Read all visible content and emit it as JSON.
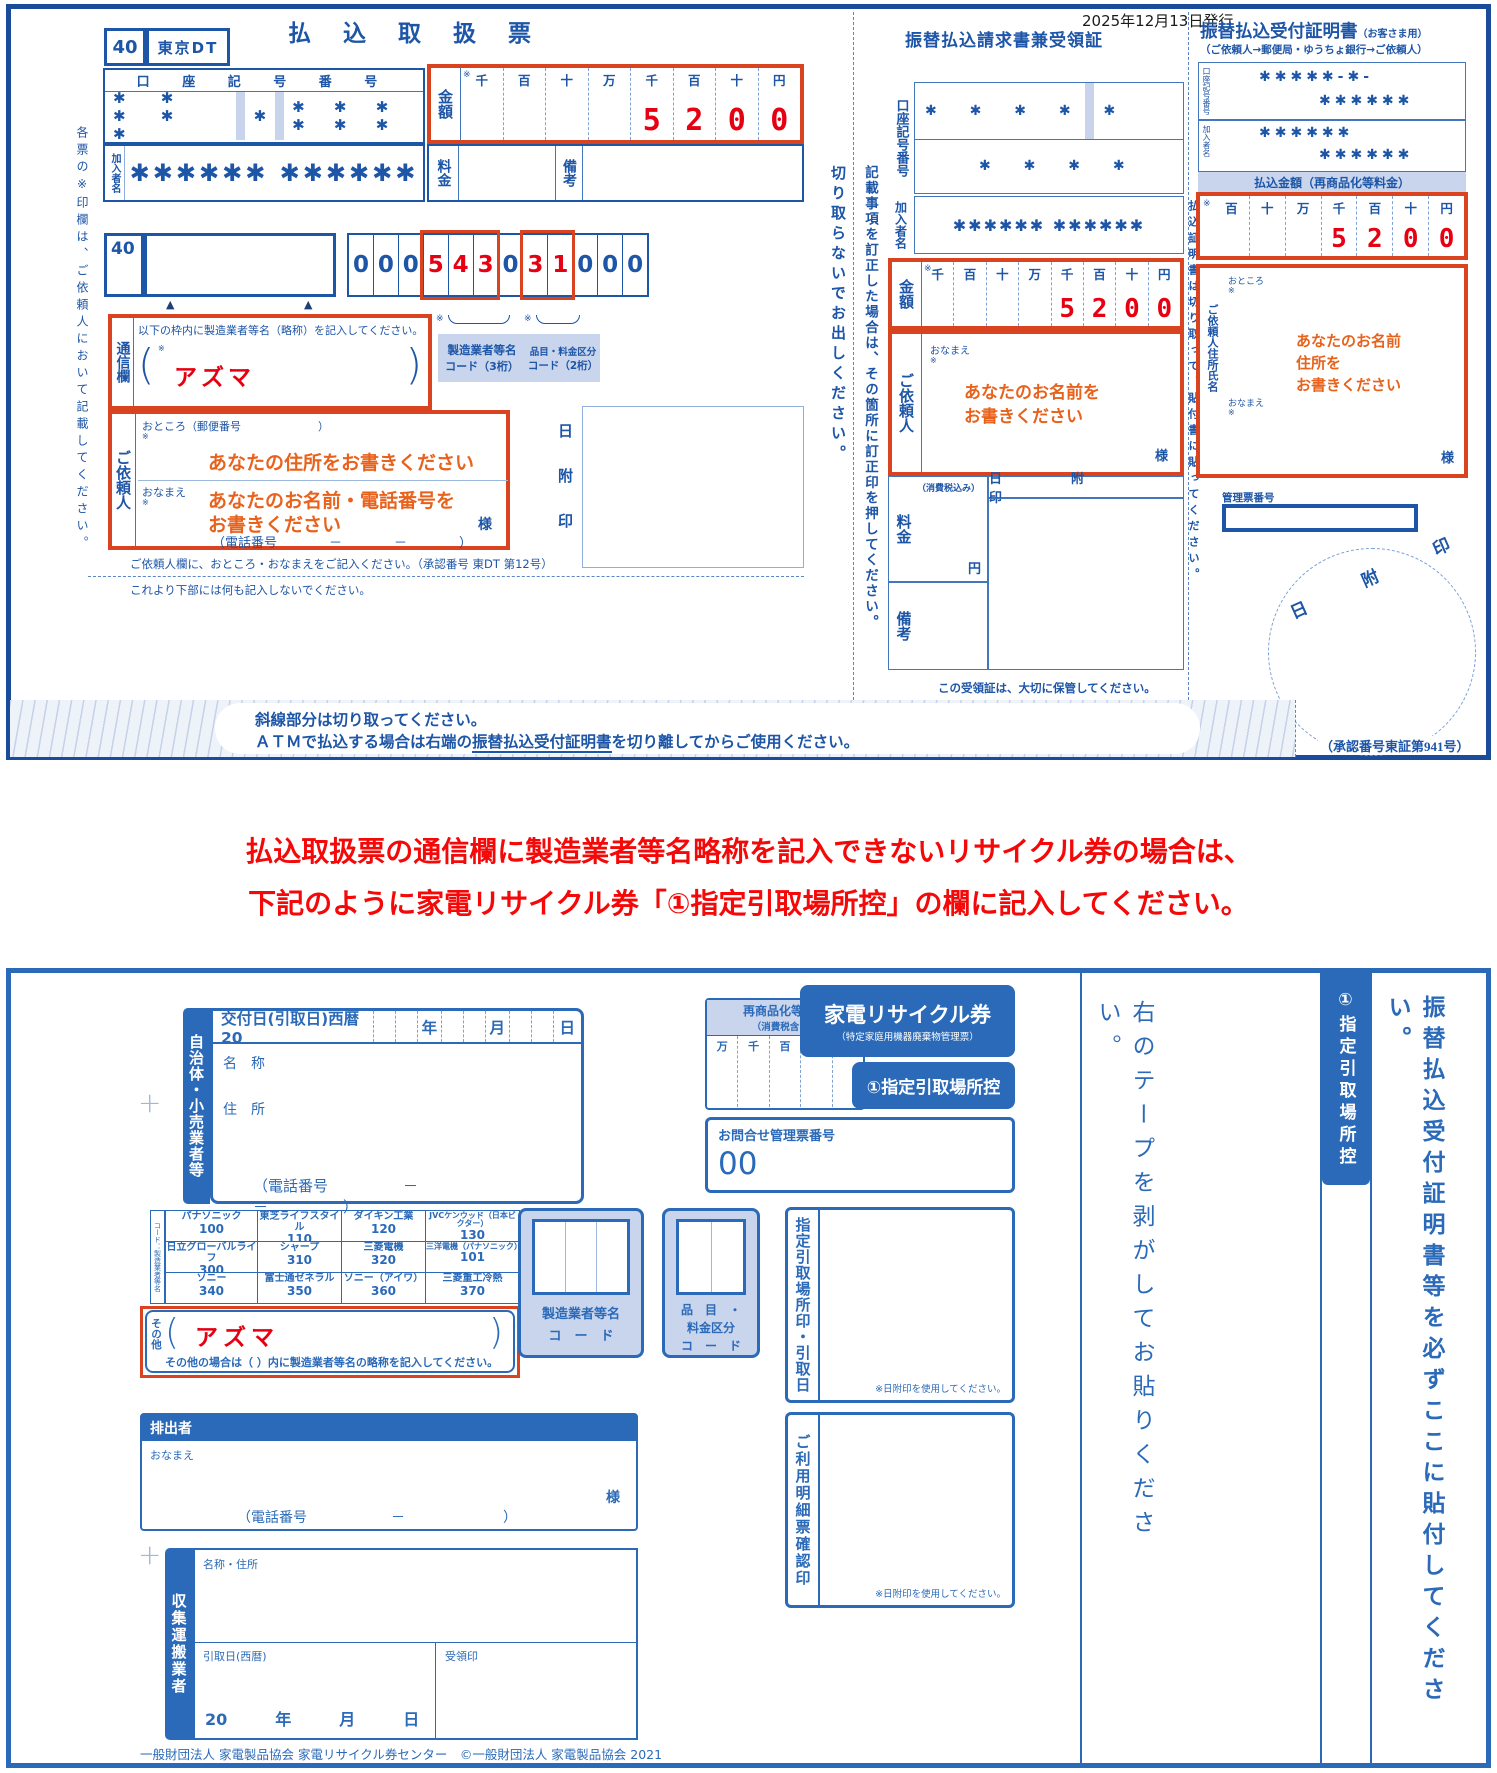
{
  "issue_date": "2025年12月13日発行",
  "glyphs": {
    "ref": "※",
    "tri": "▲",
    "plus": "+",
    "pl": "(",
    "pr": ")"
  },
  "slip": {
    "side_note": "各票の※印欄は、ご依頼人において記載してください。",
    "box40": "40",
    "office": "東京DT",
    "title": "払 込 取 扱 票",
    "account_label": "口 座 記 号 番 号",
    "stars5": "✱ ✱ ✱ ✱ ✱",
    "star1": "✱",
    "stars6": "✱ ✱ ✱ ✱ ✱ ✱",
    "amount": {
      "label": "金額",
      "cols": [
        "千",
        "百",
        "十",
        "万",
        "千",
        "百",
        "十",
        "円"
      ],
      "d": [
        "5",
        "2",
        "0",
        "0"
      ]
    },
    "member_label": "加入者名",
    "member_value": "✱✱✱✱✱✱ ✱✱✱✱✱✱",
    "fee_label": "料金",
    "remarks_label": "備考",
    "box40b": "40",
    "digits": [
      "0",
      "0",
      "0",
      "5",
      "4",
      "3",
      "0",
      "3",
      "1",
      "0",
      "0",
      "0"
    ],
    "comm": {
      "label": "通信欄",
      "instruction": "以下の枠内に製造業者等名（略称）を記入してください。",
      "value": "アズマ"
    },
    "maker_label1": "製造業者等名",
    "maker_label2": "コード（3桁）",
    "item_label1": "品目・料金区分",
    "item_label2": "コード（2桁）",
    "client": {
      "label": "ご依頼人",
      "addr": "おところ（郵便番号　　　　　　　）",
      "addr_hint": "あなたの住所をお書きください",
      "name": "おなまえ",
      "name_hint1": "あなたのお名前・電話番号を",
      "name_hint2": "お書きください",
      "sama": "様",
      "phone": "（電話番号　　　　－　　　　－　　　　）"
    },
    "stamp": [
      "日",
      "附",
      "印"
    ],
    "note1": "ご依頼人欄に、おところ・おなまえをご記入ください。（承認番号 東DT 第12号）",
    "note2": "これより下部には何も記入しないでください。"
  },
  "cut1": "切り取らないでお出しください。",
  "cut2": "記載事項を訂正した場合は、その箇所に訂正印を押してください。",
  "receipt": {
    "title": "振替払込請求書兼受領証",
    "account_label": "口座記号番号",
    "r1a": "✱ ✱ ✱ ✱",
    "r1b": "✱",
    "r2": "✱ ✱ ✱ ✱",
    "member_label": "加入者名",
    "member_value": "✱✱✱✱✱✱ ✱✱✱✱✱✱",
    "amount": {
      "label": "金額",
      "cols": [
        "千",
        "百",
        "十",
        "万",
        "千",
        "百",
        "十",
        "円"
      ],
      "d": [
        "5",
        "2",
        "0",
        "0"
      ]
    },
    "client": {
      "label": "ご依頼人",
      "name": "おなまえ",
      "hint1": "あなたのお名前を",
      "hint2": "お書きください",
      "sama": "様"
    },
    "fee_label": "料金",
    "fee_tax": "（消費税込み）",
    "yen": "円",
    "remarks_label": "備考",
    "stamp": "日　附　印",
    "keep": "この受領証は、大切に保管してください。"
  },
  "cert": {
    "title": "振替払込受付証明書",
    "title_sub": "（お客さま用）",
    "subtitle": "（ご依頼人→郵便局・ゆうちょ銀行→ご依頼人）",
    "account_label": "口座記号番号",
    "acc1": "✱✱✱✱✱-✱-",
    "acc2": "✱✱✱✱✱✱",
    "member_label": "加入者名",
    "mem1": "✱✱✱✱✱✱",
    "mem2": "✱✱✱✱✱✱",
    "amount_header": "払込金額（再商品化等料金）",
    "amount": {
      "cols": [
        "百",
        "十",
        "万",
        "千",
        "百",
        "十",
        "円"
      ],
      "d": [
        "5",
        "2",
        "0",
        "0"
      ]
    },
    "side_note": "払込証明書は切り取って、貼付書に貼ってください。",
    "client_label": "ご依頼人住所氏名",
    "addr": "おところ",
    "name": "おなまえ",
    "hint1": "あなたのお名前",
    "hint2": "住所を",
    "hint3": "お書きください",
    "sama": "様",
    "mgmt": "管理票番号",
    "stamp": "日　附　印",
    "approval": "（承認番号東証第941号）"
  },
  "band": {
    "line1": "斜線部分は切り取ってください。",
    "line2a": "ＡＴＭで払込する場合は右端の",
    "line2b": "振替払込受付証明書",
    "line2c": "を切り離してからご使用ください。"
  },
  "notice": {
    "line1": "払込取扱票の通信欄に製造業者等名略称を記入できないリサイクル券の場合は、",
    "line2": "下記のように家電リサイクル券「①指定引取場所控」の欄に記入してください。"
  },
  "ticket": {
    "issuer_tab": "自治体・小売業者等",
    "issue_prefix": "交付日(引取日)西暦 20",
    "y": "年",
    "m": "月",
    "d": "日",
    "name_label": "名　称",
    "addr_label": "住　所",
    "phone": "（電話番号　　　　　－　　　　　－　　　　　）",
    "fee_title": "再商品化等料金",
    "fee_sub": "（消費税含む）",
    "fee_cols": [
      "万",
      "千",
      "百",
      "十",
      "円"
    ],
    "title1": "家電リサイクル券",
    "title2": "（特定家庭用機器廃棄物管理票）",
    "copy_label": "①指定引取場所控",
    "inquiry_label": "お問合せ管理票番号",
    "inquiry_value": "00",
    "table_side": "コード：製造業者等名",
    "makers": [
      {
        "n": "パナソニック",
        "c": "100"
      },
      {
        "n": "東芝ライフスタイル",
        "c": "110"
      },
      {
        "n": "ダイキン工業",
        "c": "120"
      },
      {
        "n": "JVCケンウッド（日本ビクター）",
        "c": "130"
      },
      {
        "n": "日立グローバルライフ",
        "c": "300"
      },
      {
        "n": "シャープ",
        "c": "310"
      },
      {
        "n": "三菱電機",
        "c": "320"
      },
      {
        "n": "三洋電機（パナソニック）",
        "c": "101"
      },
      {
        "n": "ソニー",
        "c": "340"
      },
      {
        "n": "富士通ゼネラル",
        "c": "350"
      },
      {
        "n": "ソニー（アイワ）",
        "c": "360"
      },
      {
        "n": "三菱重工冷熱",
        "c": "370"
      }
    ],
    "other_label": "その他",
    "other_value": "アズマ",
    "other_note": "その他の場合は（ ）内に製造業者等名の略称を記入してください。",
    "maker_code": [
      "製造業者等名",
      "コ　ー　ド"
    ],
    "item_code": [
      "品　目　・",
      "料金区分",
      "コ　ー　ド"
    ],
    "stamp1": "指定引取場所印・引取日",
    "stamp2": "ご利用明細票確認印",
    "stamp_note": "※日附印を使用してください。",
    "emitter": "排出者",
    "emitter_name": "おなまえ",
    "sama": "様",
    "emitter_phone": "（電話番号　　　　　　－　　　　　　　）",
    "trans_tab": "収集運搬業者",
    "trans_name": "名称・住所",
    "pickup": "引取日(西暦)",
    "jyuryo": "受領印",
    "date_line": "20　　　年　　　月　　　日",
    "footer": "一般財団法人 家電製品協会 家電リサイクル券センター　©一般財団法人 家電製品協会 2021",
    "tape_note": "右のテープを剥がしてお貼りください。",
    "edge_tab": "①指定引取場所控",
    "paste_note": "振替払込受付証明書等を必ずここに貼付してください。"
  }
}
